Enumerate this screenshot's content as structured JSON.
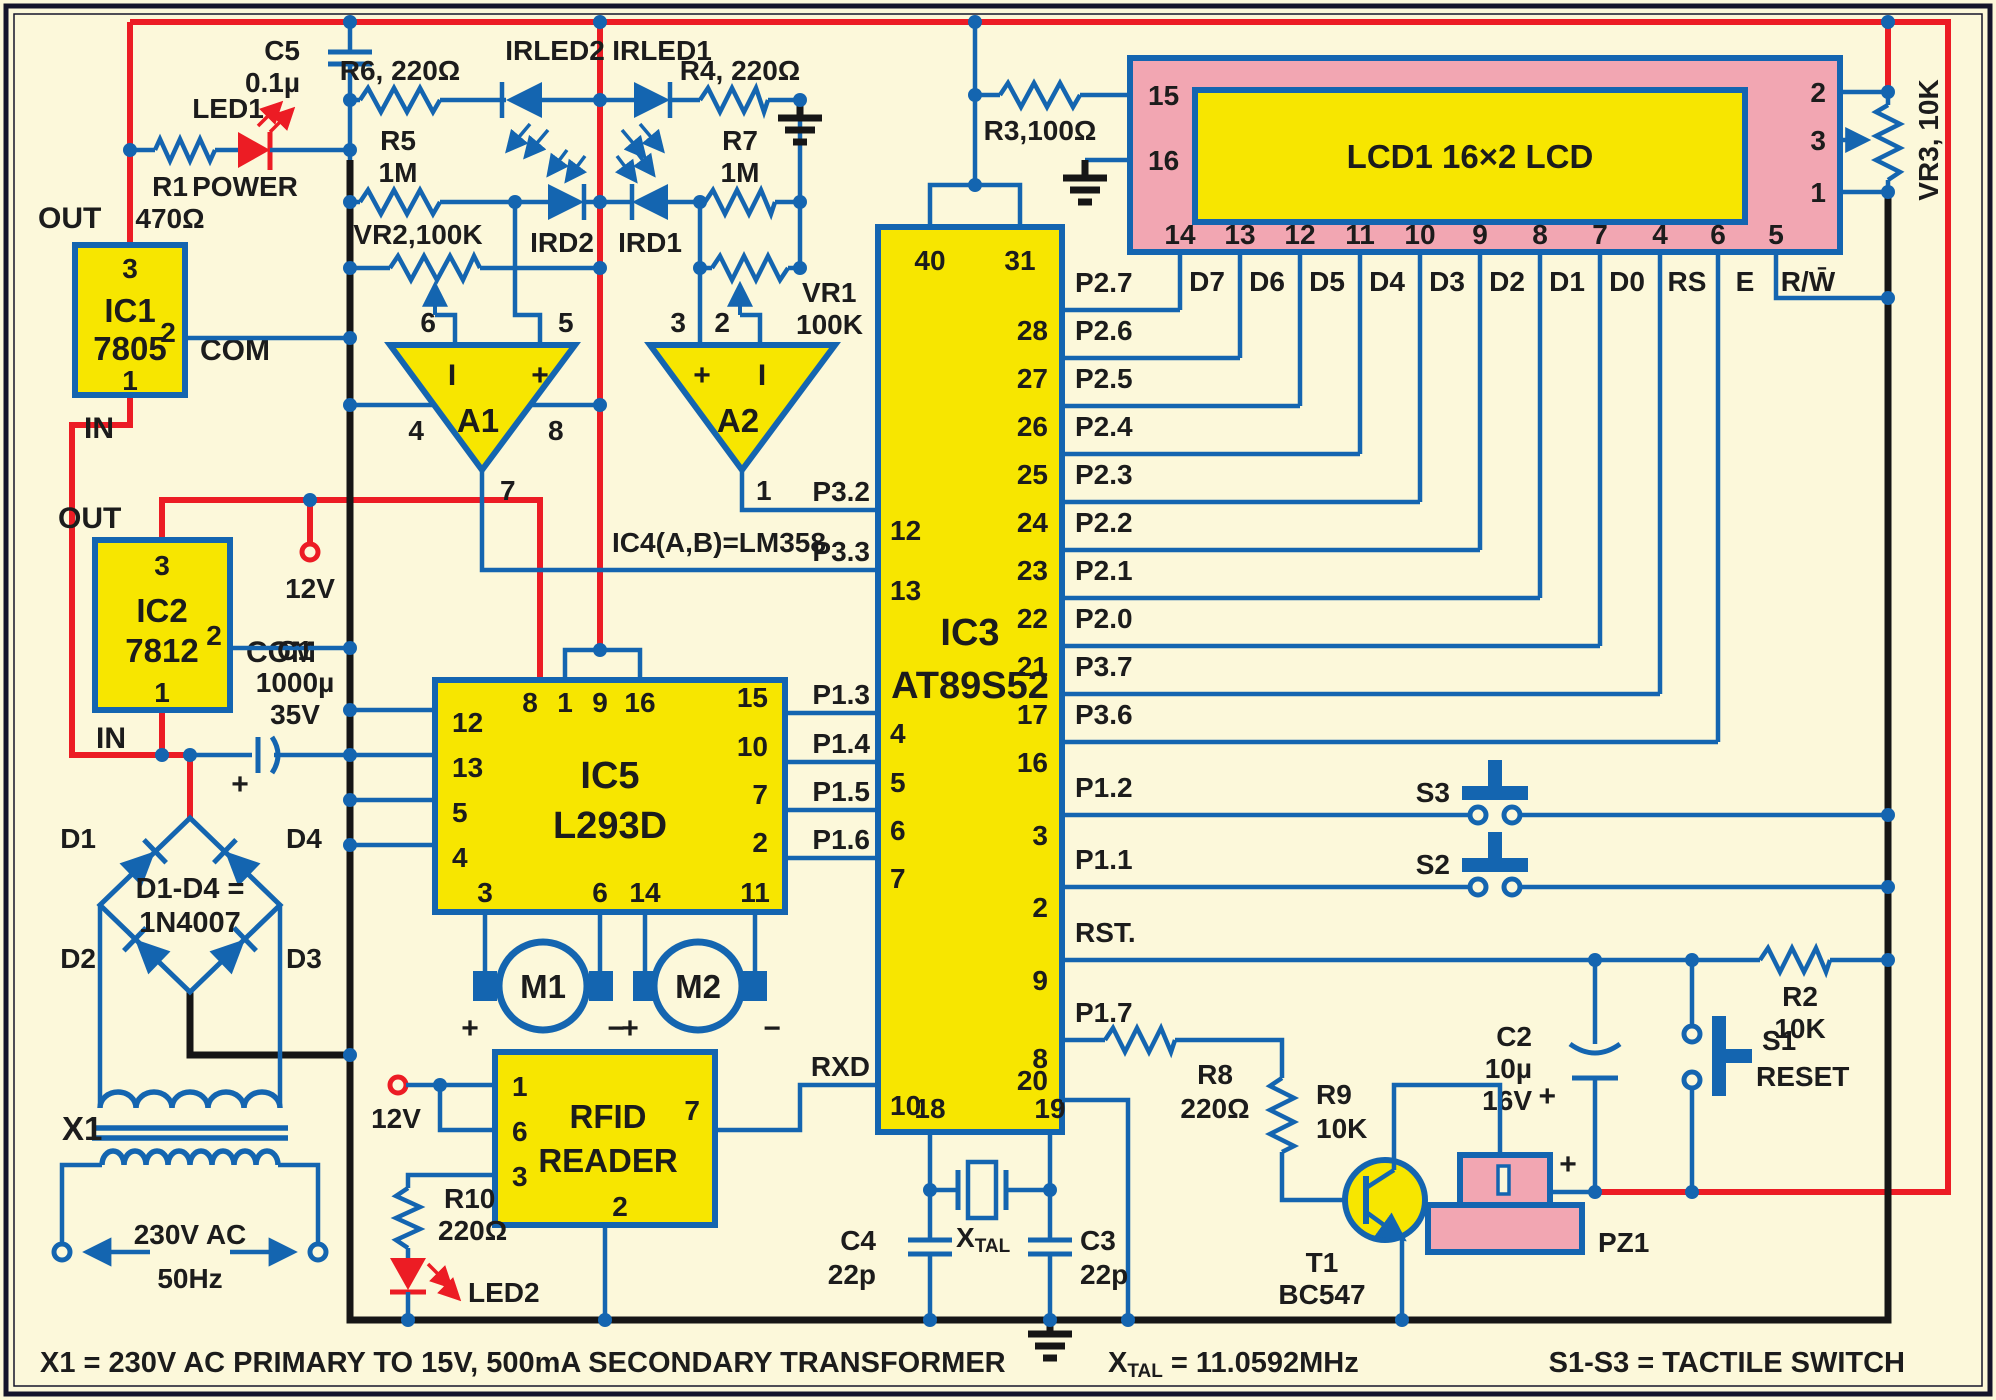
{
  "colors": {
    "background": "#fcf8da",
    "wire_blue": "#1465b0",
    "power_red": "#ec1c24",
    "ground_black": "#161616",
    "ic_yellow": "#f7e600",
    "lcd_pink": "#f2a6b2",
    "text": "#1c1c1c"
  },
  "reg": {
    "ic1": {
      "name": "IC1",
      "part": "7805",
      "p3": "3",
      "p2": "2",
      "p1": "1",
      "out": "OUT",
      "com": "COM",
      "in": "IN"
    },
    "ic2": {
      "name": "IC2",
      "part": "7812",
      "p3": "3",
      "p2": "2",
      "p1": "1",
      "out": "OUT",
      "com": "COM",
      "in": "IN"
    },
    "v12": "12V"
  },
  "pwr": {
    "r1": "R1",
    "r1v": "470Ω",
    "led1": "LED1",
    "power": "POWER",
    "c5": "C5",
    "c5v": "0.1µ"
  },
  "ir": {
    "r6": "R6, 220Ω",
    "r4": "R4, 220Ω",
    "irled2": "IRLED2",
    "irled1": "IRLED1",
    "r5": "R5",
    "r5v": "1M",
    "r7": "R7",
    "r7v": "1M",
    "ird2": "IRD2",
    "ird1": "IRD1",
    "vr2": "VR2,100K",
    "vr1": "VR1",
    "vr1v": "100K"
  },
  "op": {
    "a1": "A1",
    "a2": "A2",
    "note": "IC4(A,B)=LM358",
    "inv": "I",
    "plus": "+",
    "a1p": {
      "i": "6",
      "p": "5",
      "vm": "4",
      "vp": "8",
      "o": "7"
    },
    "a2p": {
      "p": "3",
      "i": "2",
      "o": "1"
    }
  },
  "mcu": {
    "name": "IC3",
    "part": "AT89S52",
    "p40": "40",
    "p31": "31",
    "p18": "18",
    "p19": "19",
    "p20": "20",
    "left": [
      {
        "num": "12",
        "label": "P3.2"
      },
      {
        "num": "13",
        "label": "P3.3"
      },
      {
        "num": "4",
        "label": "P1.3"
      },
      {
        "num": "5",
        "label": "P1.4"
      },
      {
        "num": "6",
        "label": "P1.5"
      },
      {
        "num": "7",
        "label": "P1.6"
      },
      {
        "num": "10",
        "label": "RXD"
      }
    ],
    "right": [
      {
        "num": "28",
        "label": "P2.7"
      },
      {
        "num": "27",
        "label": "P2.6"
      },
      {
        "num": "26",
        "label": "P2.5"
      },
      {
        "num": "25",
        "label": "P2.4"
      },
      {
        "num": "24",
        "label": "P2.3"
      },
      {
        "num": "23",
        "label": "P2.2"
      },
      {
        "num": "22",
        "label": "P2.1"
      },
      {
        "num": "21",
        "label": "P2.0"
      },
      {
        "num": "17",
        "label": "P3.7"
      },
      {
        "num": "16",
        "label": "P3.6"
      },
      {
        "num": "3",
        "label": "P1.2"
      },
      {
        "num": "2",
        "label": "P1.1"
      },
      {
        "num": "9",
        "label": "RST."
      },
      {
        "num": "8",
        "label": "P1.7"
      }
    ]
  },
  "lcd": {
    "title": "LCD1  16×2 LCD",
    "p15": "15",
    "p16": "16",
    "right": [
      "2",
      "3",
      "1"
    ],
    "bottom": [
      "14",
      "13",
      "12",
      "11",
      "10",
      "9",
      "8",
      "7",
      "4",
      "6",
      "5"
    ],
    "signals": [
      "D7",
      "D6",
      "D5",
      "D4",
      "D3",
      "D2",
      "D1",
      "D0",
      "RS",
      "E",
      "R/W̄"
    ],
    "r3": "R3,100Ω",
    "vr3": "VR3, 10K"
  },
  "drv": {
    "name": "IC5",
    "part": "L293D",
    "top": [
      "8",
      "1",
      "9",
      "16"
    ],
    "left": [
      "12",
      "13",
      "5",
      "4"
    ],
    "right": [
      "15",
      "10",
      "7",
      "2"
    ],
    "bottom": [
      "3",
      "6",
      "14",
      "11"
    ],
    "m1": "M1",
    "m2": "M2",
    "plus": "+",
    "minus": "−"
  },
  "sup": {
    "c1": "C1",
    "c1a": "1000µ",
    "c1b": "35V",
    "br1": "D1-D4 =",
    "br2": "1N4007",
    "d1": "D1",
    "d2": "D2",
    "d3": "D3",
    "d4": "D4",
    "x1": "X1",
    "ac": "230V AC",
    "hz": "50Hz",
    "plus": "+"
  },
  "rfid": {
    "t1": "RFID",
    "t2": "READER",
    "p1": "1",
    "p6": "6",
    "p3": "3",
    "p7": "7",
    "p2": "2",
    "v12": "12V",
    "r10": "R10",
    "r10v": "220Ω",
    "led2": "LED2"
  },
  "clk": {
    "xmain": "X",
    "xsub": "TAL",
    "c4": "C4",
    "c4v": "22p",
    "c3": "C3",
    "c3v": "22p"
  },
  "rst": {
    "r2": "R2",
    "r2v": "10K",
    "c2": "C2",
    "c2a": "10µ",
    "c2b": "16V",
    "s1": "S1",
    "s1l": "RESET",
    "plus": "+"
  },
  "buz": {
    "t1": "T1",
    "part": "BC547",
    "r8": "R8",
    "r8v": "220Ω",
    "r9": "R9",
    "r9v": "10K",
    "pz1": "PZ1",
    "plus": "+"
  },
  "sw": {
    "s2": "S2",
    "s3": "S3"
  },
  "cap": {
    "transformer": "X1 = 230V AC PRIMARY TO 15V, 500mA SECONDARY TRANSFORMER",
    "xtal_rest": " = 11.0592MHz",
    "tactile": "S1-S3 = TACTILE SWITCH"
  }
}
